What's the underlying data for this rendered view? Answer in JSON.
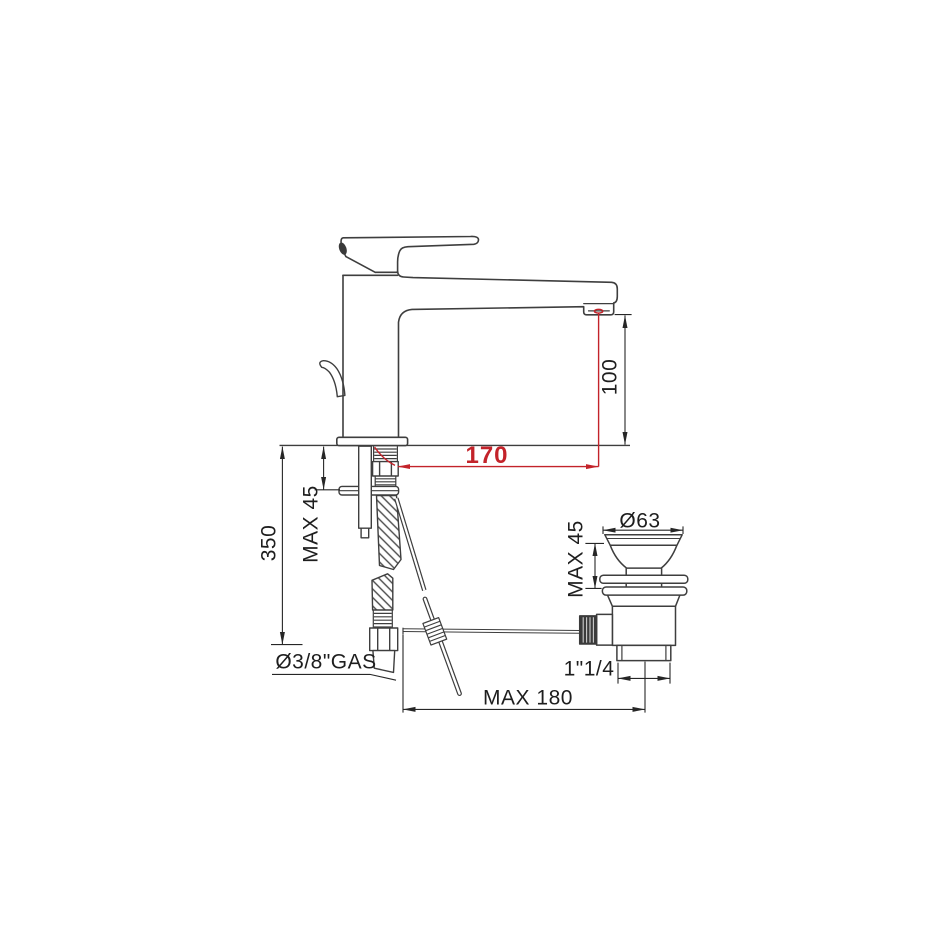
{
  "drawing": {
    "colors": {
      "background": "#ffffff",
      "line": "#3e3e3e",
      "dimension": "#262626",
      "text": "#1e1e1e",
      "accent_red": "#c3232a"
    },
    "labels": {
      "hose_length": "350",
      "deck_max_left": "MAX 45",
      "spout_height": "100",
      "spout_reach": "170",
      "supply_thread": "Ø3/8\"GAS",
      "rod_max_reach": "MAX 180",
      "drain_diameter": "Ø63",
      "drain_deck_max": "MAX 45",
      "drain_thread": "1\"1/4"
    }
  }
}
